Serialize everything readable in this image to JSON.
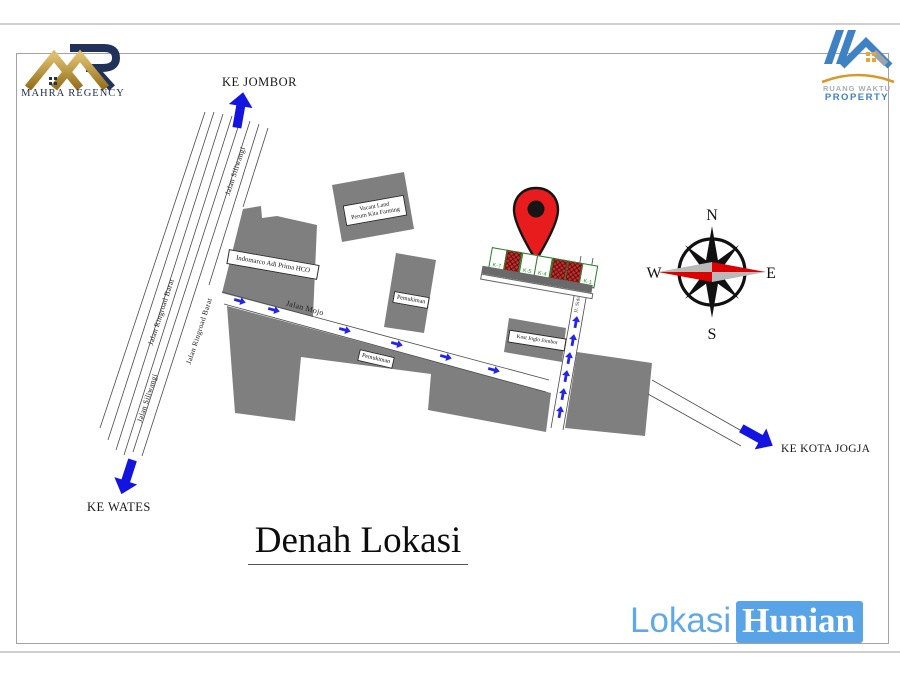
{
  "logos": {
    "mahra": {
      "text": "MAHRA REGENCY"
    },
    "ruang_waktu": {
      "line1": "RUANG WAKTU",
      "line2": "PROPERTY"
    }
  },
  "directions": {
    "ke_jombor": "KE JOMBOR",
    "ke_wates": "KE WATES",
    "ke_kota_jogja": "KE KOTA JOGJA"
  },
  "roads": {
    "siliwangi": "Jalan Siliwangi",
    "ringroad": "Jalan Ringroad Barat",
    "mojo": "Jalan Mojo",
    "sidorejo": "Jl. Sidorejo"
  },
  "buildings": {
    "indomarco": "Indomarco Adi Prima HCO",
    "vacant_line1": "Vacant Land",
    "vacant_line2": "Perum Kita Farming",
    "pemukiman": "Pemukiman",
    "kost": "Kost Joglo Jombor"
  },
  "siteplan": {
    "plots": [
      {
        "label": "K-7",
        "built": false
      },
      {
        "label": "",
        "built": true
      },
      {
        "label": "K-5",
        "built": false
      },
      {
        "label": "K-4",
        "built": false
      },
      {
        "label": "",
        "built": true
      },
      {
        "label": "",
        "built": true
      },
      {
        "label": "K-1",
        "built": false
      }
    ]
  },
  "compass": {
    "n": "N",
    "s": "S",
    "e": "E",
    "w": "W"
  },
  "title": "Denah Lokasi",
  "watermark": {
    "part1": "Lokasi",
    "part2": "Hunian"
  },
  "colors": {
    "arrow_blue": "#1414e0",
    "marker_red": "#e81c1c",
    "building_gray": "#7f7f7f",
    "brand_blue": "#58a4e6",
    "plot_green": "#1e9e1e",
    "gold": "#c9a24b",
    "navy": "#20315a"
  }
}
